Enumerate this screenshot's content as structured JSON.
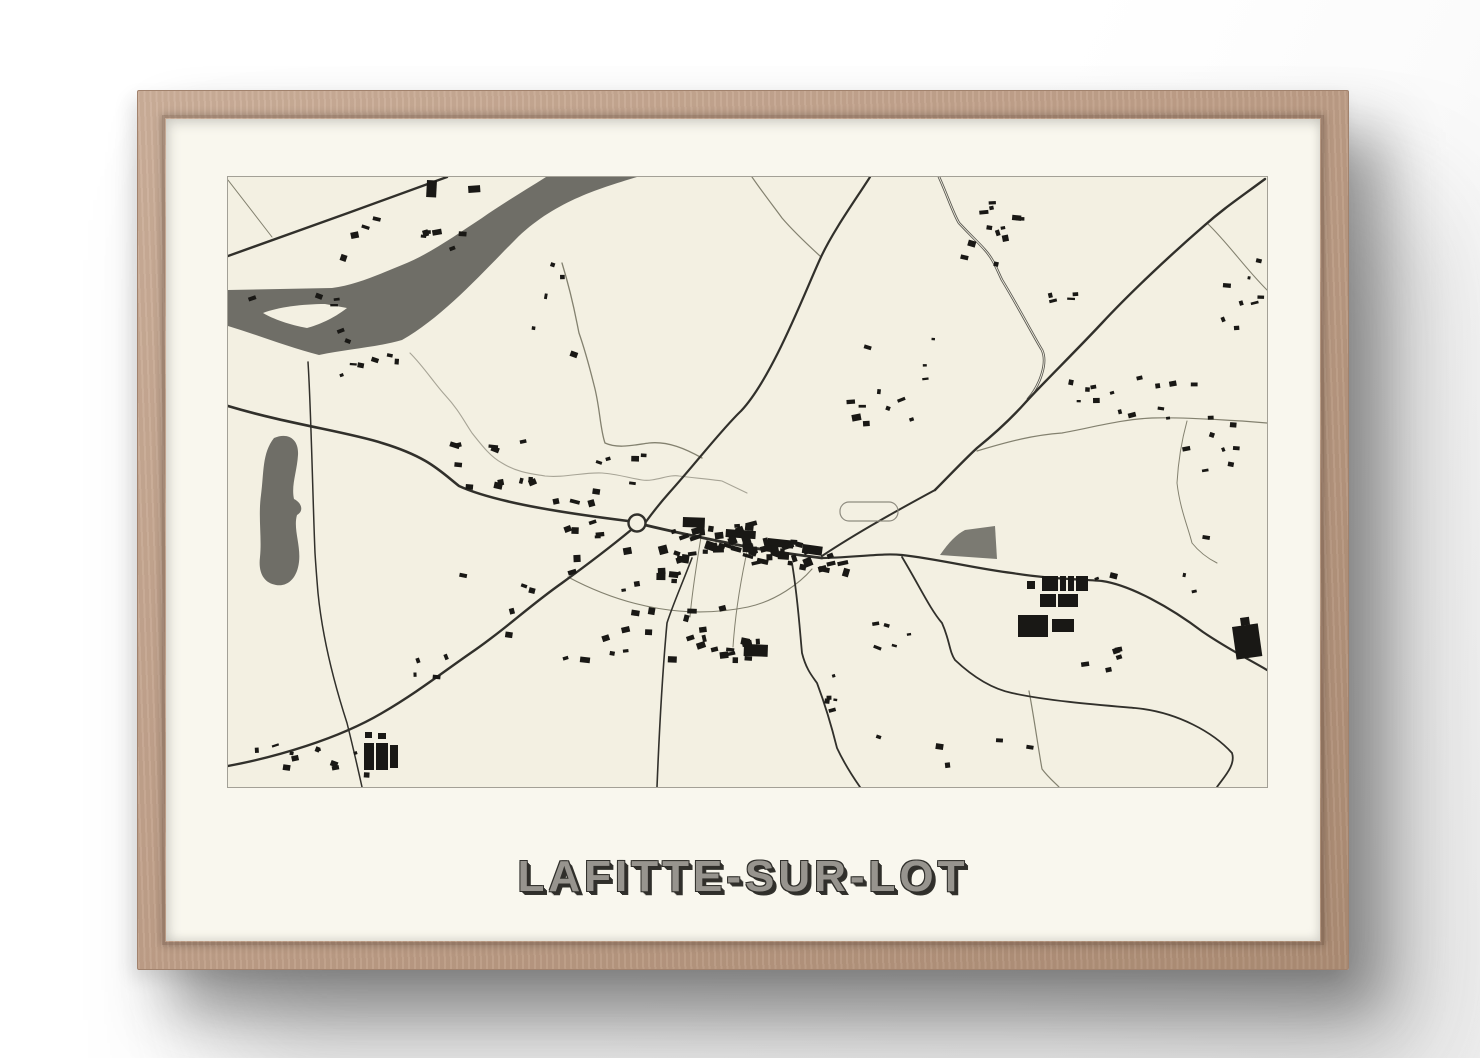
{
  "poster": {
    "title": "LAFITTE-SUR-LOT"
  },
  "frame": {
    "wood_color": "#c0a089",
    "paper_color": "#f9f7ee"
  },
  "map": {
    "viewbox": "0 0 1039 610",
    "colors": {
      "paper": "#f3f0e2",
      "water": "#6f6e67",
      "field": "#7b7a72",
      "building": "#191815",
      "road": "#31302b",
      "road_minor": "#83816f",
      "road_double": "#57564f",
      "stream": "#a7a496",
      "border": "#a3a096"
    },
    "river": "M318,0 C296,14 272,28 254,41 C228,58 200,78 174,88 C152,97 128,108 104,111 L0,113 L0,149 C30,158 60,170 91,178 C120,172 150,170 174,163 C215,140 255,95 287,63 C325,25 370,12 409,0 Z",
    "island": "M35,136 C50,130 75,127 97,127 L119,131 C105,142 90,148 79,151 C62,148 45,142 35,136 Z",
    "pond": "M46,261 C60,255 71,262 70,278 C69,295 63,308 66,322 C74,326 76,334 69,338 C65,352 73,368 71,385 C69,402 59,410 48,408 C36,406 30,396 32,380 C34,360 30,340 33,318 C36,296 34,276 46,261 Z",
    "field_wedge": "M712,378 C721,365 729,357 737,353 L767,349 L769,382 Z",
    "stream": "M182,176 C196,190 206,206 217,218 C230,232 236,244 244,256 C255,270 263,280 274,286 C290,296 306,297 317,299 C336,301 356,295 374,296 C389,297 401,301 414,303 C427,305 441,297 451,299 C466,301 481,302 494,304 L519,316",
    "roads_major": [
      {
        "d": "M0,79 L120,36 L219,0",
        "w": 2.4
      },
      {
        "d": "M0,229 C60,247 120,255 154,266 C200,280 212,294 231,309 C270,327 352,338 400,344",
        "w": 2.6
      },
      {
        "d": "M403,353 C380,372 356,390 334,406 C300,430 280,450 247,473 C215,495 190,515 154,536 C110,562 48,580 0,589",
        "w": 2.4
      },
      {
        "d": "M417,346 C425,335 433,325 441,316 C468,286 494,252 513,234 C545,200 578,112 593,80 C605,54 628,22 642,0",
        "w": 2.2
      },
      {
        "d": "M1037,2 C1010,22 995,32 977,48 C940,80 900,118 874,146 C845,177 815,206 797,226 C780,245 765,258 749,271 C735,284 720,300 707,313",
        "w": 2.4
      },
      {
        "d": "M417,348 C450,356 480,362 510,368 C540,374 570,378 594,381",
        "w": 2.8
      },
      {
        "d": "M594,379 C630,355 672,332 707,313",
        "w": 2.0
      },
      {
        "d": "M594,381 C634,380 654,376 674,378 C710,382 750,392 784,396 C820,402 850,402 874,404 C902,408 942,430 975,455 C1000,472 1022,483 1039,493",
        "w": 2.2
      },
      {
        "d": "M674,380 C692,410 702,432 714,446 C722,464 721,474 727,483 C745,500 765,512 784,516 C820,524 872,528 907,531 C950,535 986,556 1004,576 C1008,588 996,600 989,610",
        "w": 1.8
      },
      {
        "d": "M464,381 C452,412 444,430 439,446 C434,500 431,560 429,610",
        "w": 1.6
      },
      {
        "d": "M564,386 C570,422 572,456 574,476 C578,492 584,499 589,506 C598,530 604,551 609,571 C616,586 625,600 632,610",
        "w": 1.8
      },
      {
        "d": "M80,185 C83,230 85,330 87,376 C88,392 89,404 90,416 C95,466 108,512 119,546 C125,570 130,592 134,610",
        "w": 1.5
      }
    ],
    "roads_minor": [
      {
        "d": "M0,3 L44,60",
        "w": 1.0
      },
      {
        "d": "M524,0 C535,16 546,30 554,41 C566,55 580,68 592,79",
        "w": 1.2
      },
      {
        "d": "M979,46 C1000,66 1016,90 1039,113",
        "w": 1.1
      },
      {
        "d": "M334,86 C345,122 348,142 351,156 C358,176 362,192 366,208 C372,230 372,252 377,266 C390,272 406,268 421,266 C440,264 458,272 474,281",
        "w": 1.3
      },
      {
        "d": "M749,274 C782,264 806,258 834,256 C866,250 896,242 924,241 C956,240 992,243 1014,244 L1039,246",
        "w": 1.2
      },
      {
        "d": "M959,244 C953,266 950,288 949,306 C952,332 960,350 964,366 C972,376 981,382 989,386",
        "w": 1.0
      },
      {
        "d": "M801,514 C806,540 810,570 814,592 C820,600 826,605 831,610",
        "w": 1.2
      },
      {
        "d": "M340,400 C400,432 462,442 520,430 C548,424 572,406 584,392",
        "w": 1.1
      },
      {
        "d": "M474,354 C468,390 464,416 462,440",
        "w": 1.0
      },
      {
        "d": "M520,370 C512,406 507,440 505,470",
        "w": 1.0
      }
    ],
    "road_double": {
      "d": "M711,0 C720,20 725,36 731,46 C746,62 751,66 757,73 C766,83 769,93 774,103 C791,131 806,160 814,173 C820,186 812,208 800,222",
      "outer": 2.6,
      "inner": 0.9
    },
    "stadium": {
      "x": 612,
      "y": 325,
      "w": 58,
      "h": 19,
      "r": 9
    },
    "roundabout": {
      "cx": 409,
      "cy": 346,
      "r": 8.5
    },
    "buildings_large": [
      [
        814,
        399,
        16,
        15,
        0
      ],
      [
        832,
        399,
        6,
        15,
        0
      ],
      [
        840,
        399,
        6,
        15,
        0
      ],
      [
        848,
        399,
        12,
        15,
        0
      ],
      [
        812,
        417,
        16,
        13,
        0
      ],
      [
        830,
        417,
        20,
        13,
        0
      ],
      [
        790,
        438,
        30,
        22,
        0
      ],
      [
        824,
        442,
        22,
        13,
        0
      ],
      [
        799,
        404,
        8,
        8,
        0
      ],
      [
        136,
        566,
        10,
        27,
        0
      ],
      [
        148,
        566,
        12,
        27,
        0
      ],
      [
        162,
        568,
        8,
        23,
        0
      ],
      [
        150,
        556,
        8,
        6,
        0
      ],
      [
        137,
        555,
        7,
        6,
        0
      ],
      [
        1004,
        450,
        26,
        33,
        -8
      ],
      [
        1012,
        441,
        9,
        8,
        -8
      ],
      [
        455,
        340,
        22,
        10,
        2
      ],
      [
        498,
        352,
        30,
        8,
        4
      ],
      [
        540,
        361,
        26,
        8,
        6
      ],
      [
        575,
        367,
        20,
        9,
        8
      ],
      [
        199,
        3,
        10,
        17,
        3
      ],
      [
        240,
        9,
        12,
        7,
        -4
      ],
      [
        516,
        467,
        24,
        12,
        2
      ]
    ],
    "building_clusters": [
      [
        474,
        361,
        45,
        16,
        26,
        6
      ],
      [
        544,
        374,
        38,
        14,
        20,
        6
      ],
      [
        594,
        381,
        25,
        11,
        9,
        6
      ],
      [
        414,
        426,
        80,
        55,
        30,
        5
      ],
      [
        334,
        346,
        40,
        25,
        8,
        5
      ],
      [
        259,
        286,
        45,
        25,
        12,
        5
      ],
      [
        394,
        296,
        30,
        25,
        6,
        4
      ],
      [
        759,
        54,
        30,
        35,
        12,
        5
      ],
      [
        174,
        61,
        80,
        22,
        10,
        5
      ],
      [
        134,
        188,
        35,
        12,
        6,
        4
      ],
      [
        924,
        216,
        45,
        25,
        9,
        4
      ],
      [
        989,
        266,
        35,
        30,
        8,
        4
      ],
      [
        1014,
        116,
        25,
        35,
        8,
        4
      ],
      [
        852,
        211,
        15,
        12,
        5,
        4
      ],
      [
        654,
        231,
        40,
        20,
        8,
        5
      ],
      [
        514,
        471,
        35,
        12,
        8,
        5
      ],
      [
        654,
        456,
        25,
        12,
        5,
        4
      ],
      [
        74,
        581,
        70,
        15,
        12,
        4
      ],
      [
        599,
        516,
        15,
        25,
        5,
        4
      ],
      [
        874,
        481,
        30,
        15,
        5,
        4
      ],
      [
        74,
        146,
        60,
        40,
        6,
        4
      ],
      [
        294,
        126,
        60,
        50,
        5,
        4
      ],
      [
        674,
        176,
        40,
        30,
        4,
        4
      ],
      [
        924,
        376,
        60,
        40,
        5,
        4
      ],
      [
        254,
        426,
        50,
        40,
        5,
        4
      ],
      [
        724,
        566,
        80,
        25,
        5,
        4
      ],
      [
        204,
        486,
        20,
        15,
        4,
        4
      ],
      [
        834,
        126,
        18,
        12,
        4,
        4
      ]
    ]
  }
}
